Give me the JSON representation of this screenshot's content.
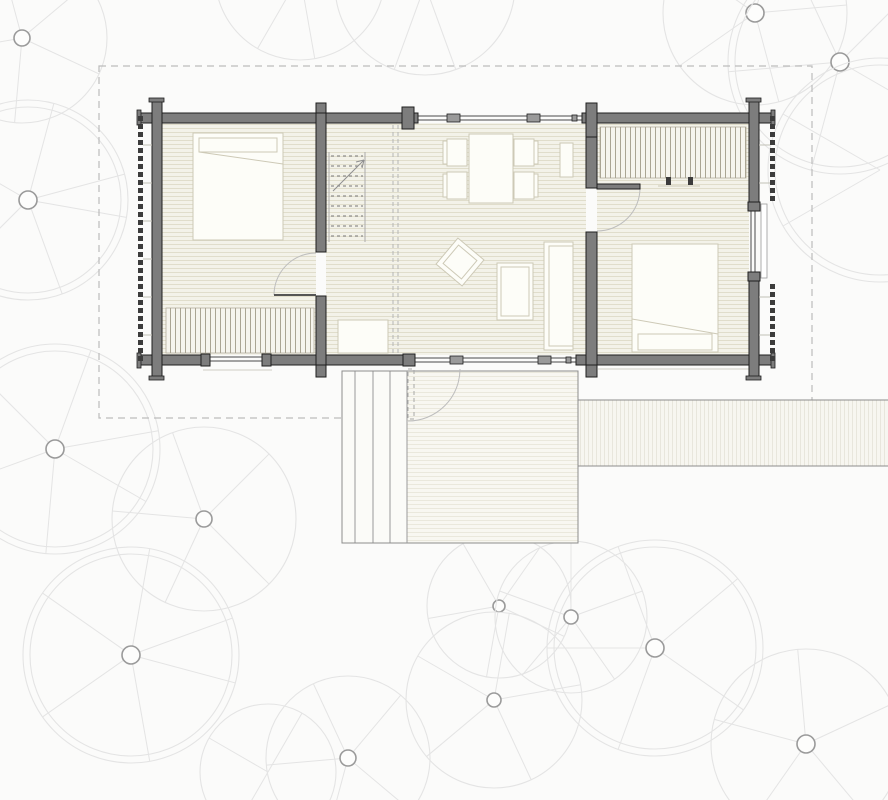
{
  "title": "log-cabin-floor-plan",
  "palette": {
    "bg": "#fbfbfa",
    "wall-fill": "#7d7d7d",
    "wall-edge": "#1f1f1f",
    "floor-fill": "#f3f2e9",
    "plank-line": "#e0ddcb",
    "deck-fill": "#f8f7f1",
    "deck-line": "#eae8dc",
    "steps-fill": "#fbfbf8",
    "furn-fill": "#fdfdf8",
    "furn-line": "#cdc9b6",
    "stripe-bg": "#f6f5ee",
    "stripe-line": "#aaa593",
    "glass-line": "#4a4a4a",
    "mullion-fill": "#9a9a9a",
    "boundary-dash": "#bcbcbc",
    "canopy": "#e4e4e4",
    "trunk": "#9a9a9a",
    "log-end": "#3c3c3c",
    "tick": "#c2c0b6",
    "arc": "#bdbdbd",
    "dash-light": "#b5b5b5",
    "walk-fill": "#f7f6f0",
    "walk-line": "#e8e6dc",
    "edge-gray": "#8c8c8c"
  },
  "canvas": {
    "w": 888,
    "h": 800
  },
  "site": {
    "boundary": [
      99,
      66,
      713,
      352
    ],
    "walkway": {
      "rect": [
        578,
        400,
        310,
        66
      ]
    },
    "deck": {
      "outline": [
        342,
        371,
        236,
        172
      ],
      "steps": [
        342,
        371,
        65,
        172
      ],
      "platform": [
        407,
        371,
        171,
        172
      ],
      "dividers": [
        355,
        373,
        390
      ]
    },
    "footings": [
      [
        203,
        370,
        272,
        370
      ],
      [
        598,
        369,
        757,
        369
      ]
    ]
  },
  "building": {
    "floors": [
      {
        "name": "floor-bedroom-west",
        "rect": [
          162,
          123,
          154,
          232
        ]
      },
      {
        "name": "floor-living",
        "rect": [
          326,
          123,
          260,
          232
        ]
      },
      {
        "name": "floor-bedroom-east",
        "rect": [
          597,
          123,
          152,
          232
        ]
      }
    ],
    "walls": [
      [
        140,
        113,
        278,
        10
      ],
      [
        582,
        113,
        190,
        10
      ],
      [
        140,
        355,
        67,
        10
      ],
      [
        266,
        355,
        139,
        10
      ],
      [
        576,
        355,
        196,
        10
      ],
      [
        152,
        101,
        10,
        276
      ],
      [
        749,
        101,
        10,
        106
      ],
      [
        749,
        277,
        10,
        100
      ],
      [
        316,
        113,
        10,
        139
      ],
      [
        316,
        296,
        10,
        69
      ],
      [
        586,
        113,
        11,
        75
      ],
      [
        586,
        232,
        11,
        133
      ]
    ],
    "posts": [
      [
        316,
        103,
        10,
        10
      ],
      [
        316,
        365,
        10,
        12
      ],
      [
        402,
        107,
        12,
        22
      ],
      [
        586,
        103,
        11,
        34
      ],
      [
        586,
        365,
        11,
        12
      ],
      [
        403,
        354,
        12,
        12
      ],
      [
        201,
        354,
        9,
        12
      ],
      [
        262,
        354,
        9,
        12
      ],
      [
        748,
        202,
        12,
        9
      ],
      [
        748,
        272,
        12,
        9
      ]
    ],
    "caps": [
      [
        137,
        110,
        4,
        15
      ],
      [
        771,
        110,
        4,
        15
      ],
      [
        137,
        353,
        4,
        15
      ],
      [
        771,
        353,
        4,
        15
      ],
      [
        149,
        98,
        15,
        4
      ],
      [
        746,
        98,
        15,
        4
      ],
      [
        149,
        376,
        15,
        4
      ],
      [
        746,
        376,
        15,
        4
      ]
    ],
    "glass_lines": [
      [
        414,
        116,
        586,
        116
      ],
      [
        414,
        120,
        586,
        120
      ],
      [
        405,
        358,
        576,
        358
      ],
      [
        405,
        362,
        576,
        362
      ],
      [
        207,
        357,
        266,
        357
      ],
      [
        207,
        361,
        266,
        361
      ],
      [
        751,
        207,
        751,
        277
      ],
      [
        755,
        207,
        755,
        277
      ]
    ],
    "mullions": [
      [
        447,
        114,
        13,
        8
      ],
      [
        527,
        114,
        13,
        8
      ],
      [
        450,
        356,
        13,
        8
      ],
      [
        538,
        356,
        13,
        8
      ]
    ],
    "glass_ticks": [
      [
        412,
        115,
        5,
        6
      ],
      [
        572,
        115,
        5,
        6
      ],
      [
        409,
        357,
        5,
        6
      ],
      [
        566,
        357,
        5,
        6
      ]
    ],
    "window_sill": [
      761,
      204,
      6,
      74
    ],
    "logs": {
      "left_x": 138,
      "right_x": 770,
      "y0": 116,
      "step": 8,
      "count": 31,
      "size": 5,
      "skip_right_y": [
        200,
        280
      ],
      "ticks_left": [
        145,
        183,
        221,
        259,
        297,
        335
      ],
      "ticks_right": [
        145,
        183,
        297,
        335
      ]
    },
    "doors": [
      {
        "name": "door-bedroom-west",
        "leaf_line": [
          316,
          295,
          274,
          295
        ],
        "arc": "M274,295 A42,42 0 0 1 316,253"
      },
      {
        "name": "door-bedroom-east",
        "leaf_rect": [
          597,
          184,
          43,
          5
        ],
        "arc": "M640,188 A43,43 0 0 1 597,231"
      },
      {
        "name": "door-entry",
        "leaf_rect": [
          408,
          369,
          6,
          50
        ],
        "leaf_dashed": true,
        "arc": "M460,369 A52,52 0 0 1 408,421"
      }
    ],
    "stairs": {
      "rails": [
        [
          329,
          152,
          329,
          242
        ],
        [
          365,
          152,
          365,
          242
        ]
      ],
      "tread_x": [
        331,
        363
      ],
      "treads_y": [
        156,
        166,
        176,
        186,
        196,
        206,
        216,
        226,
        236
      ],
      "arrow": [
        333,
        191,
        364,
        160
      ],
      "arrow_head": [
        [
          364,
          160,
          356,
          162
        ],
        [
          364,
          160,
          362,
          168
        ]
      ]
    },
    "loft_dash": [
      [
        393,
        125,
        393,
        353
      ],
      [
        398,
        125,
        398,
        353
      ]
    ]
  },
  "furniture": [
    {
      "name": "bed-west",
      "rect": [
        193,
        133,
        90,
        107
      ],
      "inner": [
        [
          199,
          138,
          78,
          14
        ]
      ],
      "lines": [
        [
          199,
          152,
          283,
          164
        ]
      ]
    },
    {
      "name": "wardrobe-west",
      "rect": [
        166,
        308,
        148,
        45
      ],
      "stripes": true
    },
    {
      "name": "entry-cabinet",
      "rect": [
        338,
        320,
        50,
        33
      ]
    },
    {
      "name": "dining-table",
      "rect": [
        469,
        134,
        44,
        69
      ]
    },
    {
      "name": "dining-chair",
      "rect": [
        447,
        139,
        20,
        27
      ],
      "back": [
        443,
        141,
        4,
        23
      ]
    },
    {
      "name": "dining-chair",
      "rect": [
        447,
        172,
        20,
        27
      ],
      "back": [
        443,
        174,
        4,
        23
      ]
    },
    {
      "name": "dining-chair",
      "rect": [
        514,
        139,
        20,
        27
      ],
      "back": [
        534,
        141,
        4,
        23
      ]
    },
    {
      "name": "dining-chair",
      "rect": [
        514,
        172,
        20,
        27
      ],
      "back": [
        534,
        174,
        4,
        23
      ]
    },
    {
      "name": "kitchen-unit",
      "rect": [
        560,
        143,
        13,
        34
      ]
    },
    {
      "name": "armchair",
      "rect": [
        443,
        245,
        34,
        34
      ],
      "rotate": [
        40,
        460,
        262
      ],
      "inner": [
        [
          448,
          250,
          24,
          24
        ]
      ]
    },
    {
      "name": "coffee-table",
      "rect": [
        497,
        263,
        36,
        57
      ],
      "inner": [
        [
          501,
          267,
          28,
          49
        ]
      ]
    },
    {
      "name": "sofa",
      "rect": [
        544,
        242,
        29,
        108
      ],
      "inner": [
        [
          549,
          246,
          24,
          100
        ]
      ]
    },
    {
      "name": "wardrobe-east",
      "rect": [
        600,
        127,
        146,
        51
      ],
      "stripes": true
    },
    {
      "name": "bed-east",
      "rect": [
        632,
        244,
        86,
        108
      ],
      "inner": [
        [
          638,
          334,
          74,
          16
        ]
      ],
      "lines": [
        [
          632,
          319,
          718,
          334
        ]
      ]
    }
  ],
  "marks": {
    "knobs": [
      [
        666,
        177,
        5,
        8
      ],
      [
        688,
        177,
        5,
        8
      ]
    ],
    "lines": [
      [
        658,
        186,
        700,
        186
      ]
    ]
  },
  "trees": [
    {
      "cx": 22,
      "cy": 38,
      "tr": 8,
      "cr": 85,
      "ang": [
        25,
        95,
        170,
        255,
        320
      ]
    },
    {
      "cx": 28,
      "cy": 200,
      "tr": 9,
      "cr": 100,
      "ang": [
        10,
        70,
        135,
        210,
        285,
        345
      ]
    },
    {
      "cx": 55,
      "cy": 449,
      "tr": 9,
      "cr": 105,
      "ang": [
        30,
        95,
        160,
        225,
        290,
        350
      ]
    },
    {
      "cx": 204,
      "cy": 519,
      "tr": 8,
      "cr": 92,
      "ang": [
        45,
        115,
        185,
        250,
        315
      ]
    },
    {
      "cx": 131,
      "cy": 655,
      "tr": 9,
      "cr": 108,
      "ang": [
        15,
        80,
        145,
        215,
        280,
        340
      ]
    },
    {
      "cx": 348,
      "cy": 758,
      "tr": 8,
      "cr": 82,
      "ang": [
        40,
        105,
        175,
        245,
        310
      ]
    },
    {
      "cx": 499,
      "cy": 606,
      "tr": 6,
      "cr": 72,
      "ang": [
        25,
        100,
        170,
        240,
        305
      ]
    },
    {
      "cx": 571,
      "cy": 617,
      "tr": 7,
      "cr": 76,
      "ang": [
        55,
        130,
        200,
        270,
        340
      ]
    },
    {
      "cx": 655,
      "cy": 648,
      "tr": 9,
      "cr": 108,
      "ang": [
        35,
        110,
        180,
        250,
        320
      ]
    },
    {
      "cx": 494,
      "cy": 700,
      "tr": 7,
      "cr": 88,
      "ang": [
        65,
        140,
        210,
        280,
        350
      ]
    },
    {
      "cx": 806,
      "cy": 744,
      "tr": 9,
      "cr": 95,
      "ang": [
        50,
        125,
        195,
        265,
        335
      ]
    },
    {
      "cx": 755,
      "cy": 13,
      "tr": 9,
      "cr": 92,
      "ang": [
        75,
        145,
        215,
        285,
        355
      ]
    },
    {
      "cx": 840,
      "cy": 62,
      "tr": 9,
      "cr": 112,
      "ang": [
        30,
        105,
        175,
        245,
        315
      ]
    },
    {
      "cx": 425,
      "cy": -15,
      "tr": 0,
      "cr": 90,
      "ang": [
        70,
        110,
        250
      ]
    },
    {
      "cx": 300,
      "cy": -25,
      "tr": 0,
      "cr": 85,
      "ang": [
        80,
        120
      ]
    },
    {
      "cx": 880,
      "cy": 170,
      "tr": 0,
      "cr": 112,
      "ang": [
        150,
        210
      ]
    },
    {
      "cx": 268,
      "cy": 772,
      "tr": 0,
      "cr": 68,
      "ang": [
        120,
        210,
        300
      ]
    }
  ]
}
